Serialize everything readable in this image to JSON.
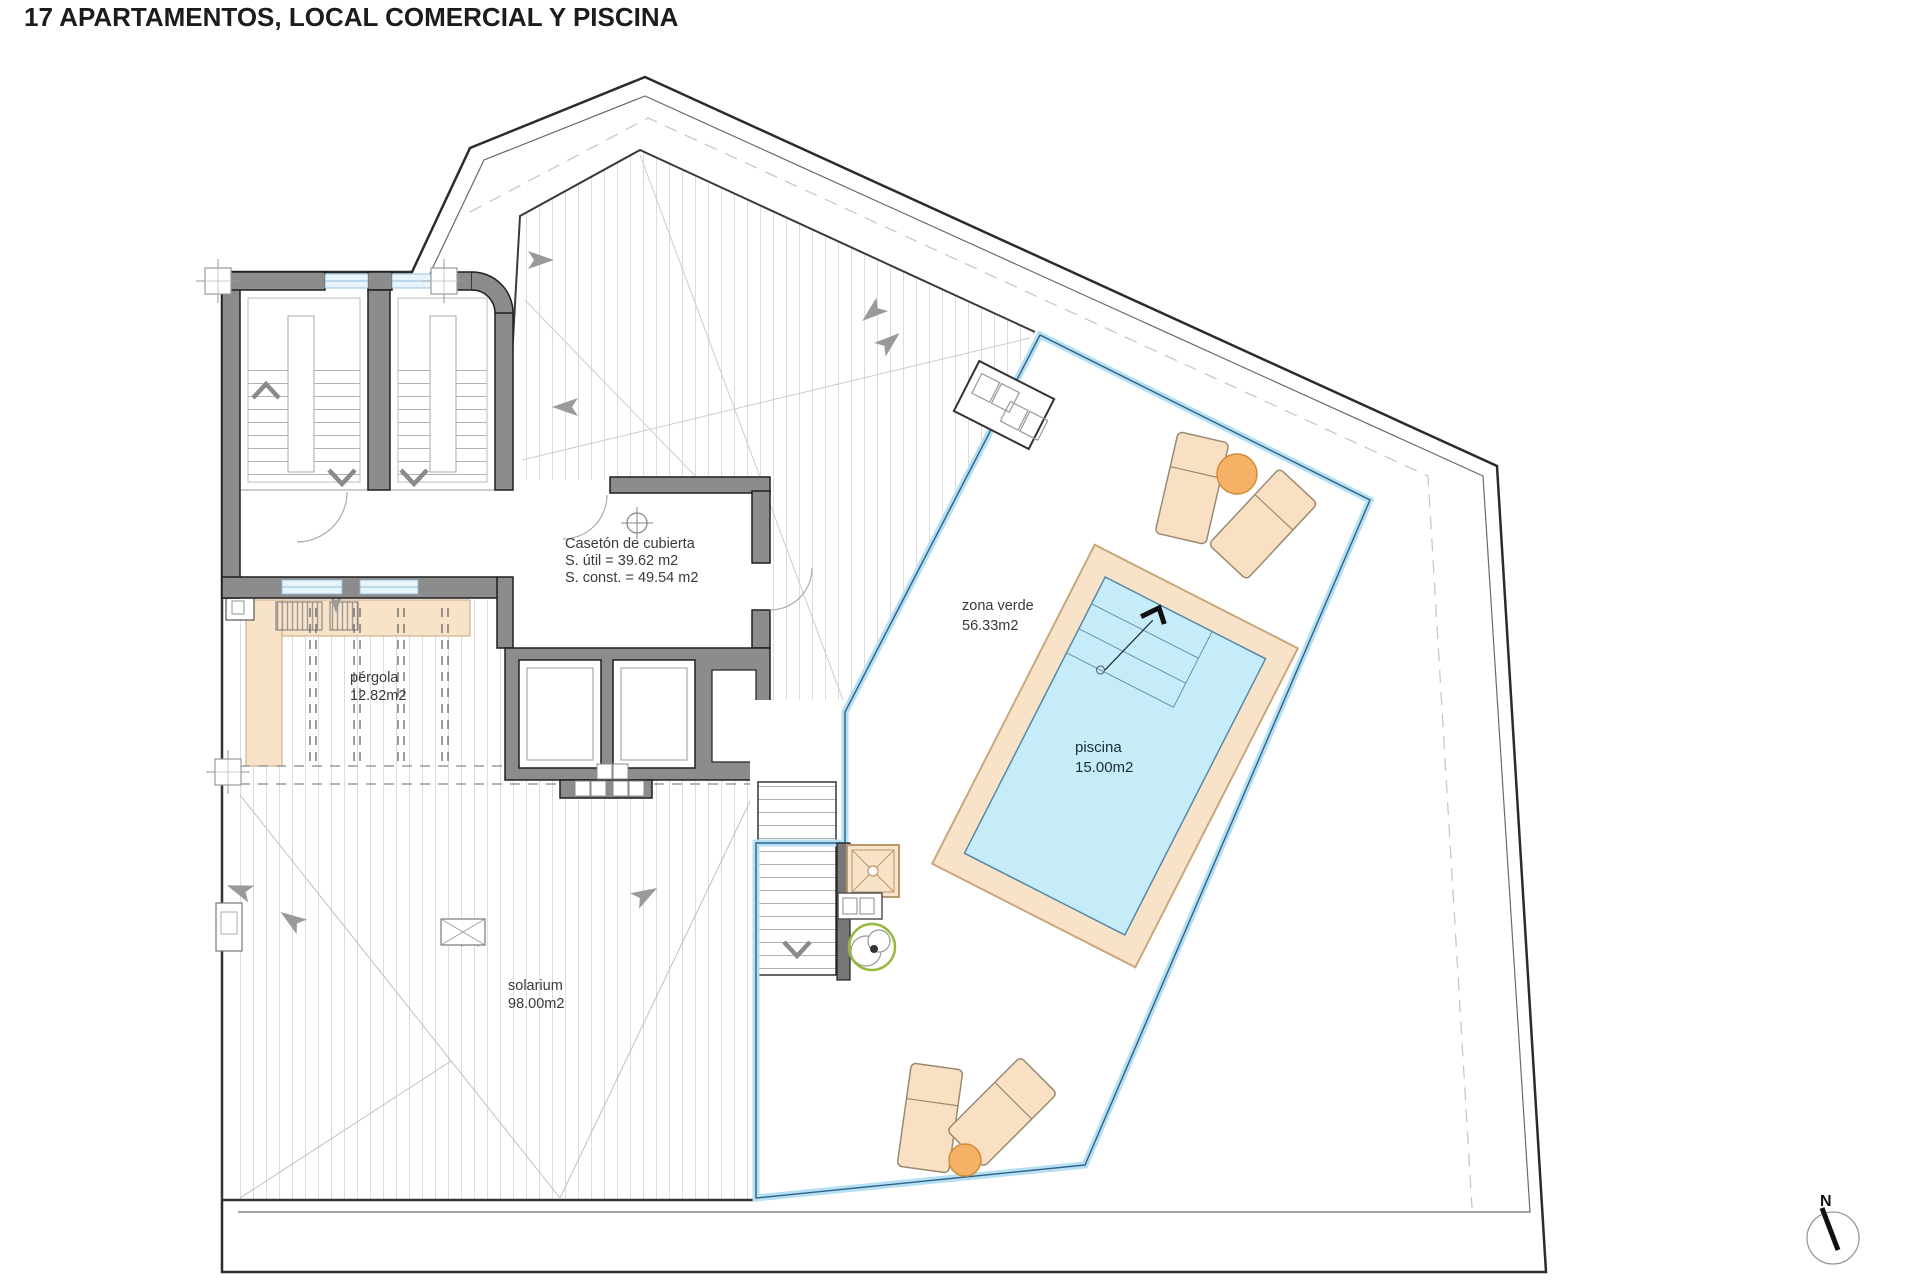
{
  "title": "17 APARTAMENTOS, LOCAL COMERCIAL Y PISCINA",
  "labels": {
    "caseton": {
      "line1": "Casetón de cubierta",
      "line2": "S. útil = 39.62 m2",
      "line3": "S. const. = 49.54 m2"
    },
    "zona_verde": {
      "name": "zona verde",
      "area": "56.33m2"
    },
    "piscina": {
      "name": "piscina",
      "area": "15.00m2"
    },
    "solarium": {
      "name": "solarium",
      "area": "98.00m2"
    },
    "pergola": {
      "name": "pérgola",
      "area": "12.82m2"
    },
    "north": "N"
  },
  "colors": {
    "wall_gray": "#8c8c8c",
    "wall_outline": "#1f1f1f",
    "pool_water": "#c5ecf8",
    "deck_tan": "#f9e3c8",
    "lounger_tan": "#fae0c3",
    "table_orange": "#f5b266",
    "balustrade_blue": "#b5dff2",
    "balustrade_line": "#2e6086",
    "window_blue": "#e8f4fb",
    "plant_green": "#97b83c",
    "deck_stripe": "#dcdcdc"
  }
}
